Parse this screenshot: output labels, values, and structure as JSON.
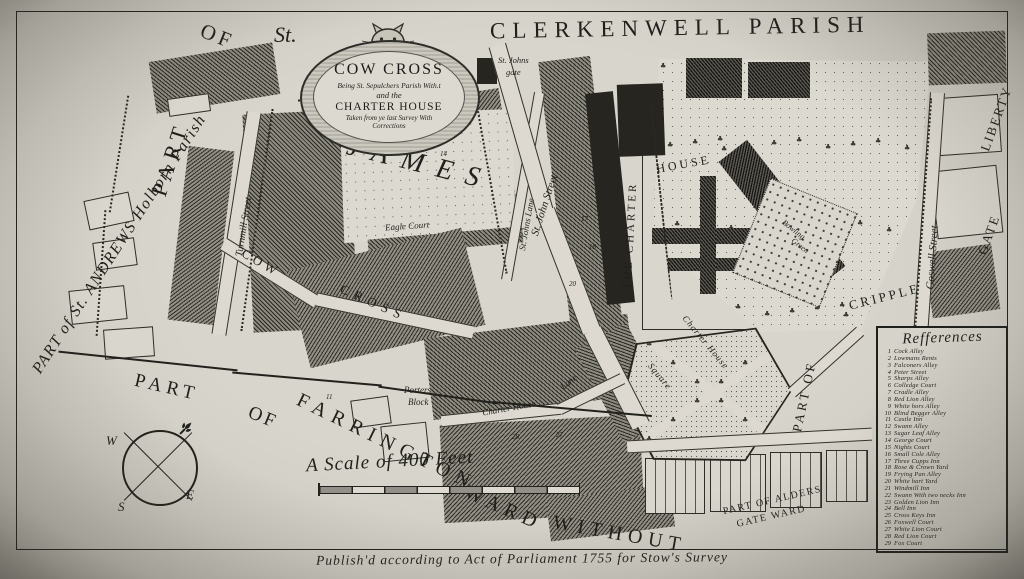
{
  "map": {
    "regions": {
      "clerkenwell_parish": "CLERKENWELL PARISH",
      "st_andrews": "PART of St. ANDREWS Holborn Parish",
      "part": "PART",
      "of": "OF",
      "st": "St.",
      "james": "JAMES",
      "farrington_part": "PART",
      "farrington_of": "OF",
      "farrington_name": "FARRINGTON",
      "farrington_ward": "WARD",
      "farrington_without": "WITHOUT",
      "aldersgate_line1": "PART OF ALDERS",
      "aldersgate_line2": "GATE WARD",
      "part_of_right": "PART OF",
      "cripple": "CRIPPLE",
      "gate": "GATE",
      "liberty": "LIBERTY"
    },
    "cartouche": {
      "title": "COW CROSS",
      "line2": "Being St. Sepulchers Parish With.t",
      "line3": "and the",
      "line4": "CHARTER HOUSE",
      "line5": "Taken from ye last Survey With",
      "line6": "Corrections"
    },
    "streets": {
      "turnmill": "Turnmill Street",
      "cow": "COW",
      "cross": "CROSS",
      "st_johns_lane": "St. Johns Lane",
      "st_john_street": "St. John Street",
      "eagle_court": "Eagle Court",
      "st_johns_gate_1": "St. Johns",
      "st_johns_gate_2": "gate",
      "the_charter": "THE CHARTER",
      "house": "HOUSE",
      "charter_house": "Charter House",
      "lane": "Lane",
      "porters_1": "Porters",
      "porters_2": "Block",
      "square_label_1": "Charter House",
      "square_label_2": "Square",
      "bowling_1": "Bowling",
      "bowling_2": "Green",
      "goswell": "Goswell Street"
    },
    "compass": {
      "w": "W",
      "e": "E",
      "s": "S"
    },
    "scale_label": "A Scale of 400 Feet",
    "references": {
      "title": "Refferences",
      "items": [
        {
          "n": "1",
          "label": "Cock Alley"
        },
        {
          "n": "2",
          "label": "Lowmans Rents"
        },
        {
          "n": "3",
          "label": "Falconers Alley"
        },
        {
          "n": "4",
          "label": "Peter Street"
        },
        {
          "n": "5",
          "label": "Sharps Alley"
        },
        {
          "n": "6",
          "label": "Colledge Court"
        },
        {
          "n": "7",
          "label": "Cradle Alley"
        },
        {
          "n": "8",
          "label": "Red Lion Alley"
        },
        {
          "n": "9",
          "label": "White hors Alley"
        },
        {
          "n": "10",
          "label": "Blind Begger Alley"
        },
        {
          "n": "11",
          "label": "Castle Inn"
        },
        {
          "n": "12",
          "label": "Swann Alley"
        },
        {
          "n": "13",
          "label": "Sugar Leaf Alley"
        },
        {
          "n": "14",
          "label": "George Court"
        },
        {
          "n": "15",
          "label": "Nights Court"
        },
        {
          "n": "16",
          "label": "Small Cole Alley"
        },
        {
          "n": "17",
          "label": "Three Cupps Inn"
        },
        {
          "n": "18",
          "label": "Rose & Crown Yard"
        },
        {
          "n": "19",
          "label": "Frying Pan Alley"
        },
        {
          "n": "20",
          "label": "White hart Yard"
        },
        {
          "n": "21",
          "label": "Windmill Inn"
        },
        {
          "n": "22",
          "label": "Swann With two necks Inn"
        },
        {
          "n": "23",
          "label": "Golden Lion Inn"
        },
        {
          "n": "24",
          "label": "Bell Inn"
        },
        {
          "n": "25",
          "label": "Cross Keys Inn"
        },
        {
          "n": "26",
          "label": "Foxwell Court"
        },
        {
          "n": "27",
          "label": "White Lion Court"
        },
        {
          "n": "28",
          "label": "Red Lion Court"
        },
        {
          "n": "29",
          "label": "Fox Court"
        }
      ]
    },
    "plot_numbers": [
      {
        "n": "11",
        "x": 326,
        "y": 393
      },
      {
        "n": "14",
        "x": 440,
        "y": 150
      },
      {
        "n": "17",
        "x": 581,
        "y": 215
      },
      {
        "n": "18",
        "x": 589,
        "y": 243
      },
      {
        "n": "20",
        "x": 569,
        "y": 280
      },
      {
        "n": "27",
        "x": 556,
        "y": 431
      },
      {
        "n": "28",
        "x": 512,
        "y": 433
      }
    ],
    "imprint": "Publish'd according to Act of Parliament 1755 for Stow's Survey"
  }
}
